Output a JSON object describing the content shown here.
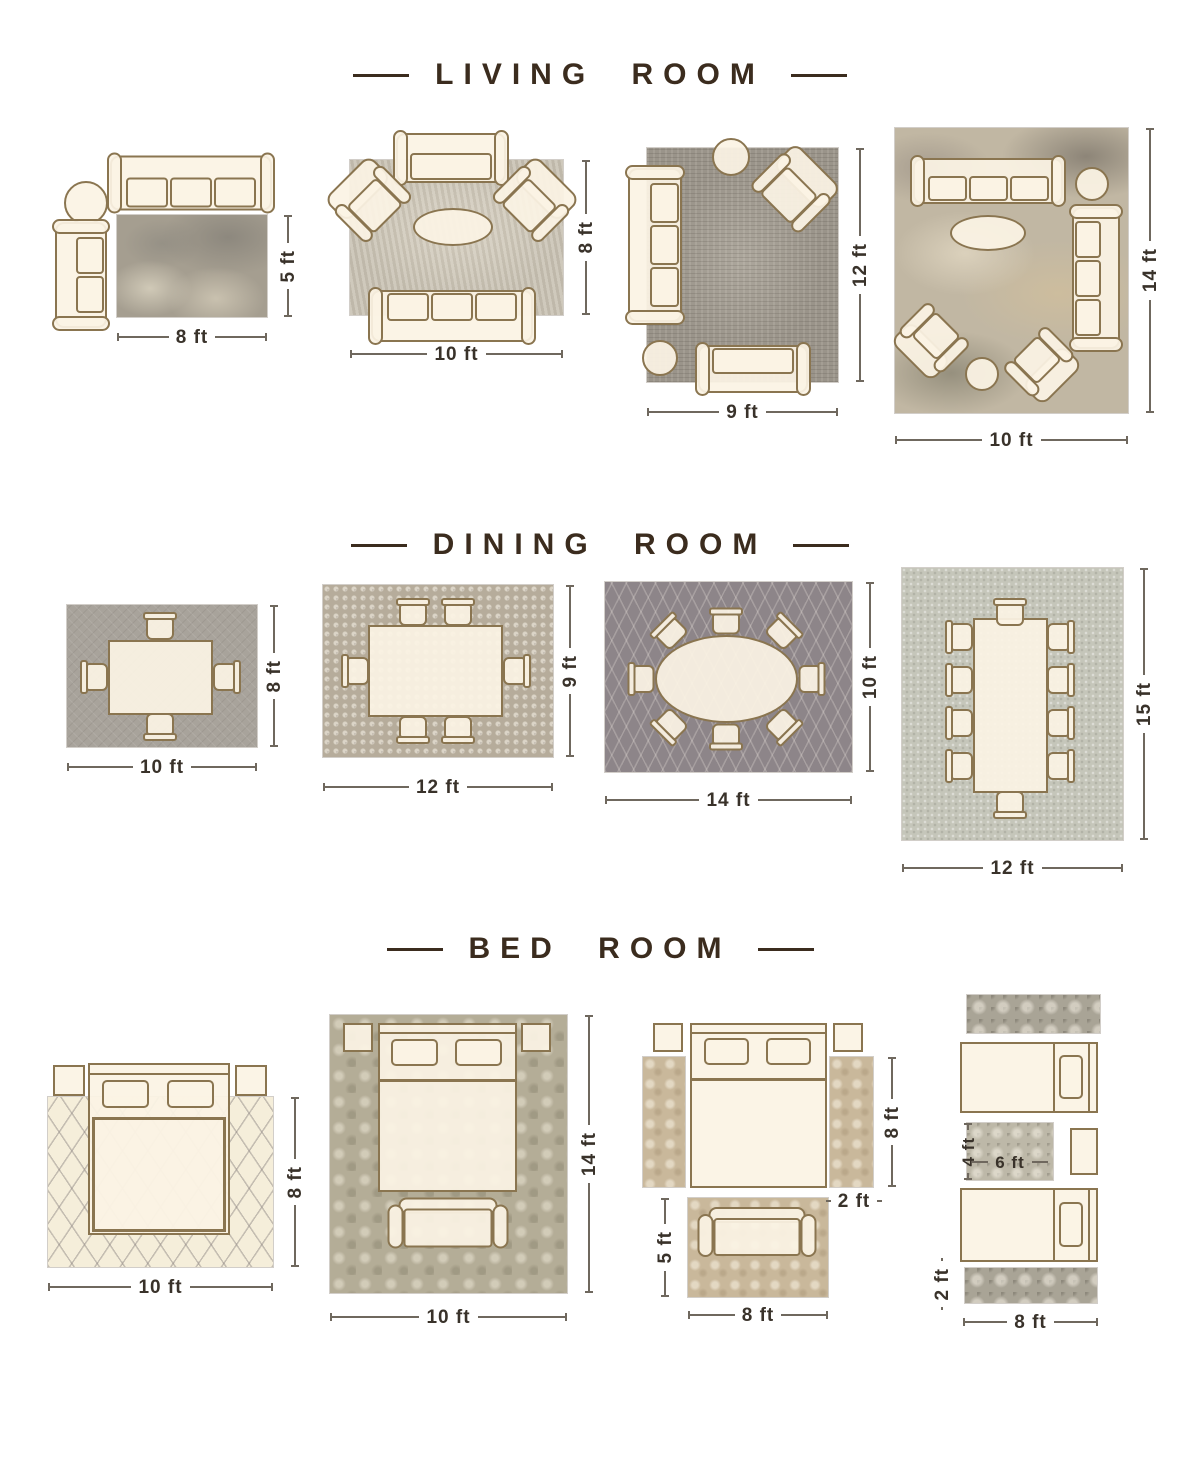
{
  "colors": {
    "title": "#3b2c1e",
    "dimension_text": "#39322a",
    "furniture_fill": "#fbf3e4",
    "furniture_outline": "#8a7550"
  },
  "sections": [
    {
      "title": "LIVING ROOM",
      "layouts": [
        {
          "width_label": "8 ft",
          "height_label": "5 ft"
        },
        {
          "width_label": "10 ft",
          "height_label": "8 ft"
        },
        {
          "width_label": "9 ft",
          "height_label": "12 ft"
        },
        {
          "width_label": "10 ft",
          "height_label": "14 ft"
        }
      ]
    },
    {
      "title": "DINING ROOM",
      "layouts": [
        {
          "width_label": "10 ft",
          "height_label": "8 ft"
        },
        {
          "width_label": "12 ft",
          "height_label": "9 ft"
        },
        {
          "width_label": "14 ft",
          "height_label": "10 ft"
        },
        {
          "width_label": "12 ft",
          "height_label": "15 ft"
        }
      ]
    },
    {
      "title": "BED ROOM",
      "layouts": [
        {
          "width_label": "10 ft",
          "height_label": "8 ft"
        },
        {
          "width_label": "10 ft",
          "height_label": "14 ft"
        },
        {
          "runner_height_label": "8 ft",
          "runner_width_label": "2 ft",
          "foot_rug_height_label": "5 ft",
          "foot_rug_width_label": "8 ft"
        },
        {
          "accent_rug_height_label": "4 ft",
          "accent_rug_width_label": "6 ft",
          "runner_height_label": "2 ft",
          "runner_width_label": "8 ft"
        }
      ]
    }
  ]
}
